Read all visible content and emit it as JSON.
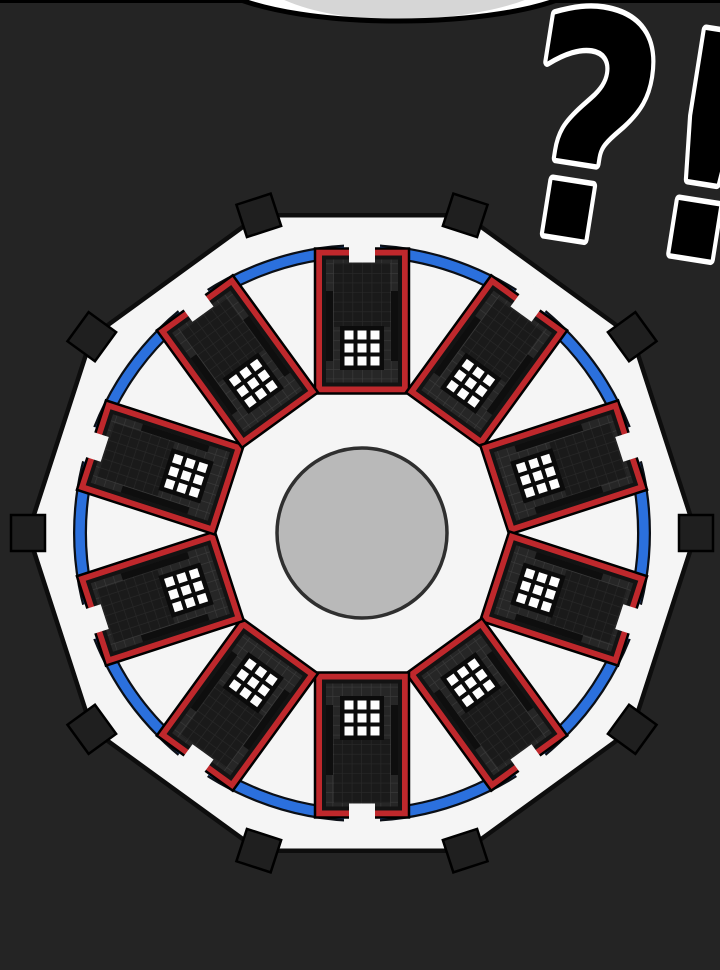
{
  "panel": {
    "interjection": "?!",
    "scene_description": "Aerial top-down comic view of a ten-sided prison complex: ten dark cell-block buildings with red frames and 3x3 white skylight grids arranged radially around a gray central courtyard, enclosed by a blue perimeter ring inside a white decagonal wall with ten dark gate tabs at its vertices; a white speech bubble pokes in at the top edge and a large startled interjection overlaps the top right.",
    "building_count": 10,
    "gate_tab_count": 10,
    "skylight_grid": "3x3"
  },
  "colors": {
    "background": "#242424",
    "outline": "#000000",
    "wall-fill": "#f5f5f5",
    "ring-blue": "#2b70dd",
    "ring-edge": "#0b0f16",
    "building-red": "#bf282c",
    "building-dark": "#131313",
    "roof": "#262626",
    "roof-line": "#3b3b3b",
    "window": "#fdfdfd",
    "window-bg": "#0b0b0b",
    "courtyard": "#b9b9b9",
    "courtyard-edge": "#2f2f2f",
    "tab": "#1f1f1f",
    "bubble": "#ffffff",
    "bubble-shade": "#d6d6d6",
    "mark-fill": "#000000",
    "mark-outline": "#ffffff"
  }
}
